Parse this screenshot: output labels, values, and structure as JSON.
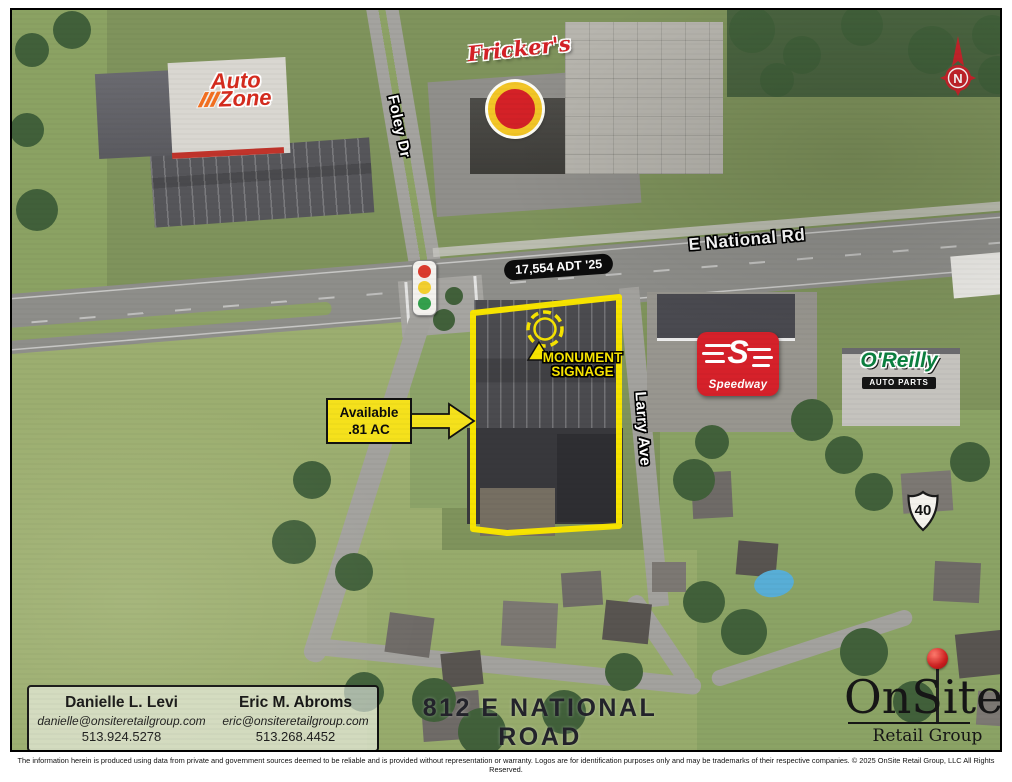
{
  "map": {
    "streets": {
      "foley": "Foley Dr",
      "national": "E National Rd",
      "larry": "Larry Ave"
    },
    "traffic_count": "17,554 ADT '25",
    "monument": {
      "line1": "MONUMENT",
      "line2": "SIGNAGE"
    },
    "available": {
      "line1": "Available",
      "line2": ".81 AC"
    },
    "route_shield": "40",
    "compass": "N",
    "logos": {
      "autozone_top": "Auto",
      "autozone_bottom": "Zone",
      "frickers": "Fricker's",
      "speedway": "Speedway",
      "oreilly": "O'Reilly",
      "oreilly_sub": "AUTO PARTS"
    }
  },
  "footer": {
    "contacts": [
      {
        "name": "Danielle L. Levi",
        "email": "danielle@onsiteretailgroup.com",
        "phone": "513.924.5278"
      },
      {
        "name": "Eric M. Abroms",
        "email": "eric@onsiteretailgroup.com",
        "phone": "513.268.4452"
      }
    ],
    "address": {
      "line1": "812 E NATIONAL ROAD",
      "line2": "Vandalia, OH 45377"
    },
    "brand": {
      "main": "OnSite",
      "sub": "Retail Group"
    },
    "disclaimer": "The information herein is produced using data from private and government sources deemed to be reliable and is provided without representation or warranty. Logos are for identification purposes only and may be trademarks of their respective companies. © 2025 OnSite Retail Group, LLC All Rights Reserved."
  },
  "colors": {
    "highlight_yellow": "#f7e400",
    "speedway_red": "#d6212a",
    "oreilly_green": "#0c8040",
    "autozone_red": "#d52b1e",
    "autozone_orange": "#f37021",
    "pin_red": "#cc1f1f"
  }
}
